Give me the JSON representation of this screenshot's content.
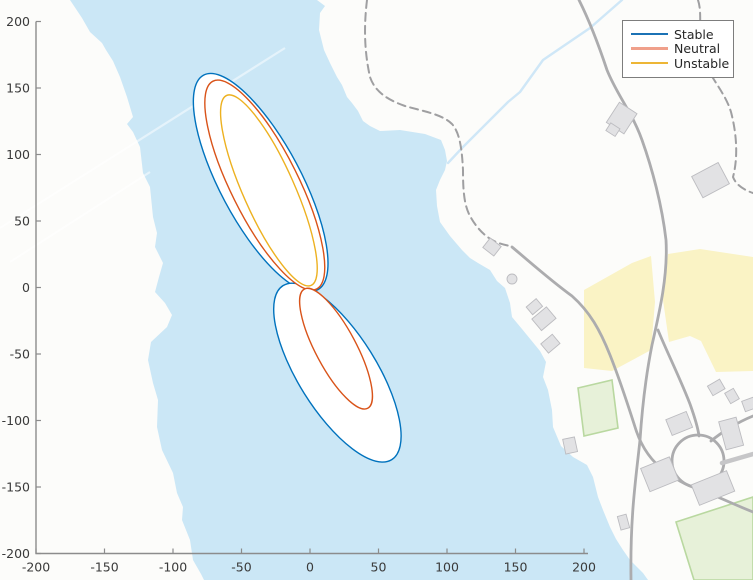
{
  "figure": {
    "kind": "matlab-style map plot with stability contour ellipses over a lakeside map"
  },
  "chart_data": {
    "type": "line",
    "title": "",
    "xlabel": "",
    "ylabel": "",
    "xlim": [
      -200,
      200
    ],
    "ylim": [
      -200,
      200
    ],
    "grid": false,
    "x_ticks": [
      -200,
      -150,
      -100,
      -50,
      0,
      50,
      100,
      150,
      200
    ],
    "y_ticks": [
      -200,
      -150,
      -100,
      -50,
      0,
      50,
      100,
      150,
      200
    ],
    "legend": {
      "position": "top-right",
      "entries": [
        {
          "label": "Stable",
          "color": "#0072BD",
          "swatch": "#1B72B5",
          "weight": 2
        },
        {
          "label": "Neutral",
          "color": "#D95319",
          "swatch": "#F0A08B",
          "weight": 3
        },
        {
          "label": "Unstable",
          "color": "#EDB120",
          "swatch": "#EDB636",
          "weight": 2
        }
      ]
    },
    "series": [
      {
        "name": "Stable",
        "color": "#0072BD",
        "shape": "ellipse-contours",
        "ellipses": [
          {
            "cx": -36,
            "cy": 79,
            "a": 90,
            "b": 30,
            "angle_deg": 118
          },
          {
            "cx": 20,
            "cy": -64,
            "a": 76,
            "b": 29,
            "angle_deg": -58
          }
        ]
      },
      {
        "name": "Neutral",
        "color": "#D95319",
        "shape": "ellipse-contours",
        "ellipses": [
          {
            "cx": -33,
            "cy": 77,
            "a": 86,
            "b": 25,
            "angle_deg": 116.5
          },
          {
            "cx": 19,
            "cy": -46,
            "a": 50,
            "b": 15,
            "angle_deg": -62
          }
        ]
      },
      {
        "name": "Unstable",
        "color": "#EDB120",
        "shape": "ellipse-contours",
        "ellipses": [
          {
            "cx": -30,
            "cy": 73,
            "a": 77,
            "b": 19,
            "angle_deg": 114
          }
        ]
      }
    ]
  },
  "map": {
    "colors": {
      "water": "#CBE7F6",
      "land": "#FCFCFA",
      "road": "#ACACAE",
      "path": "#9F9FA1",
      "building_fill": "#E2E2E4",
      "building_stroke": "#BCBCC0",
      "farmland": "#FAF3C5",
      "field_fill": "#E7F1D9",
      "field_stroke": "#B9D8A0",
      "stream": "#CFE7F7",
      "axis": "#8C8C8C",
      "tick_label": "#3A3A3A"
    },
    "features": [
      "lake",
      "shoreline",
      "stream",
      "roads",
      "roundabout",
      "dashed-footpaths",
      "buildings",
      "farmland",
      "green-fields"
    ]
  }
}
